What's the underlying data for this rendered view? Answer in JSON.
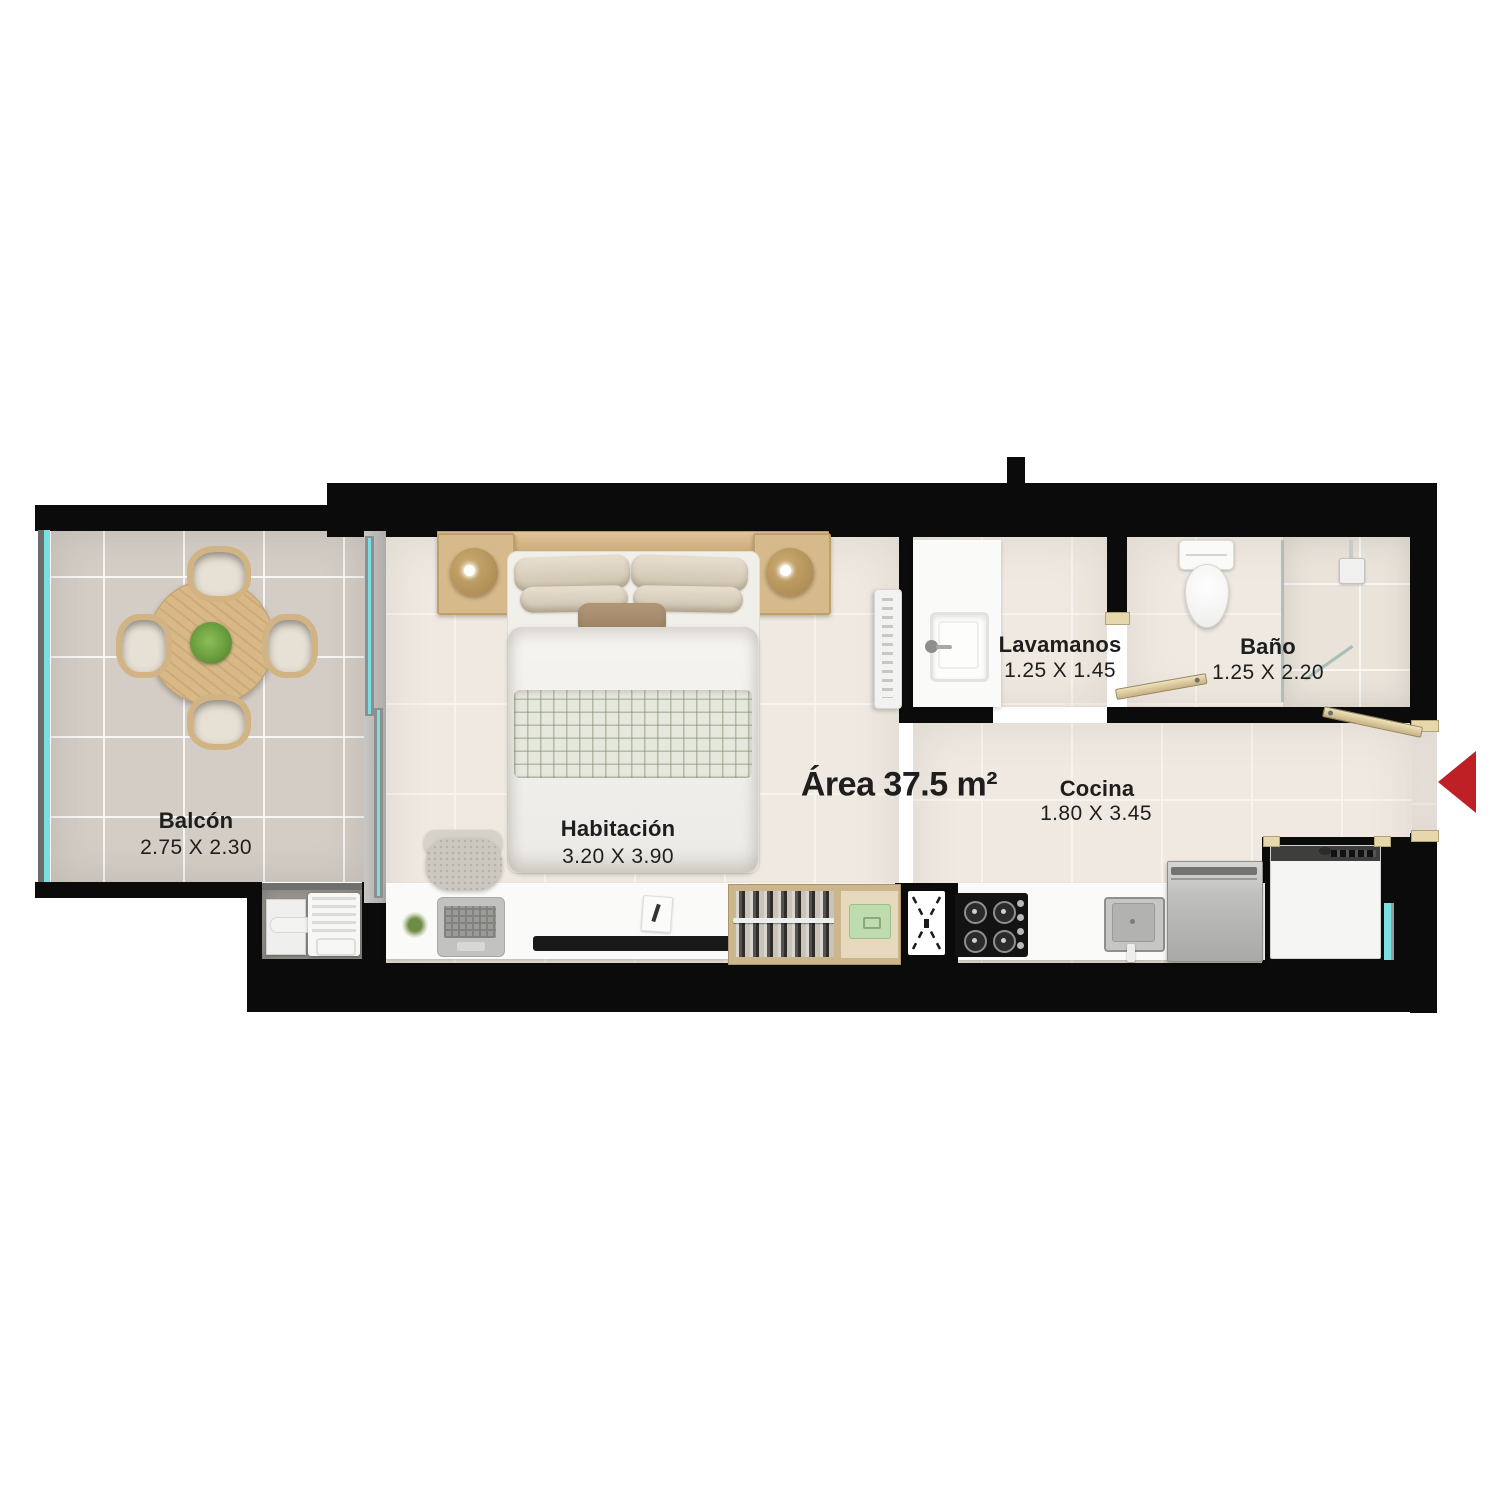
{
  "plan": {
    "area": {
      "label": "Área 37.5 m²"
    },
    "rooms": {
      "balcon": {
        "name": "Balcón",
        "dims": "2.75 X 2.30"
      },
      "habitacion": {
        "name": "Habitación",
        "dims": "3.20 X 3.90"
      },
      "lavamanos": {
        "name": "Lavamanos",
        "dims": "1.25 X 1.45"
      },
      "bano": {
        "name": "Baño",
        "dims": "1.25 X 2.20"
      },
      "cocina": {
        "name": "Cocina",
        "dims": "1.80 X 3.45"
      }
    },
    "entrance": {
      "marker": "entrance-arrow"
    },
    "colors": {
      "wall": "#0B0B0B",
      "floor_interior": "#EFE9E1",
      "floor_balcony": "#D3CDC6",
      "glass": "#7ADFE2",
      "wood": "#D9BD90",
      "accent_red": "#BE2026",
      "text": "#1E1E1E"
    }
  }
}
